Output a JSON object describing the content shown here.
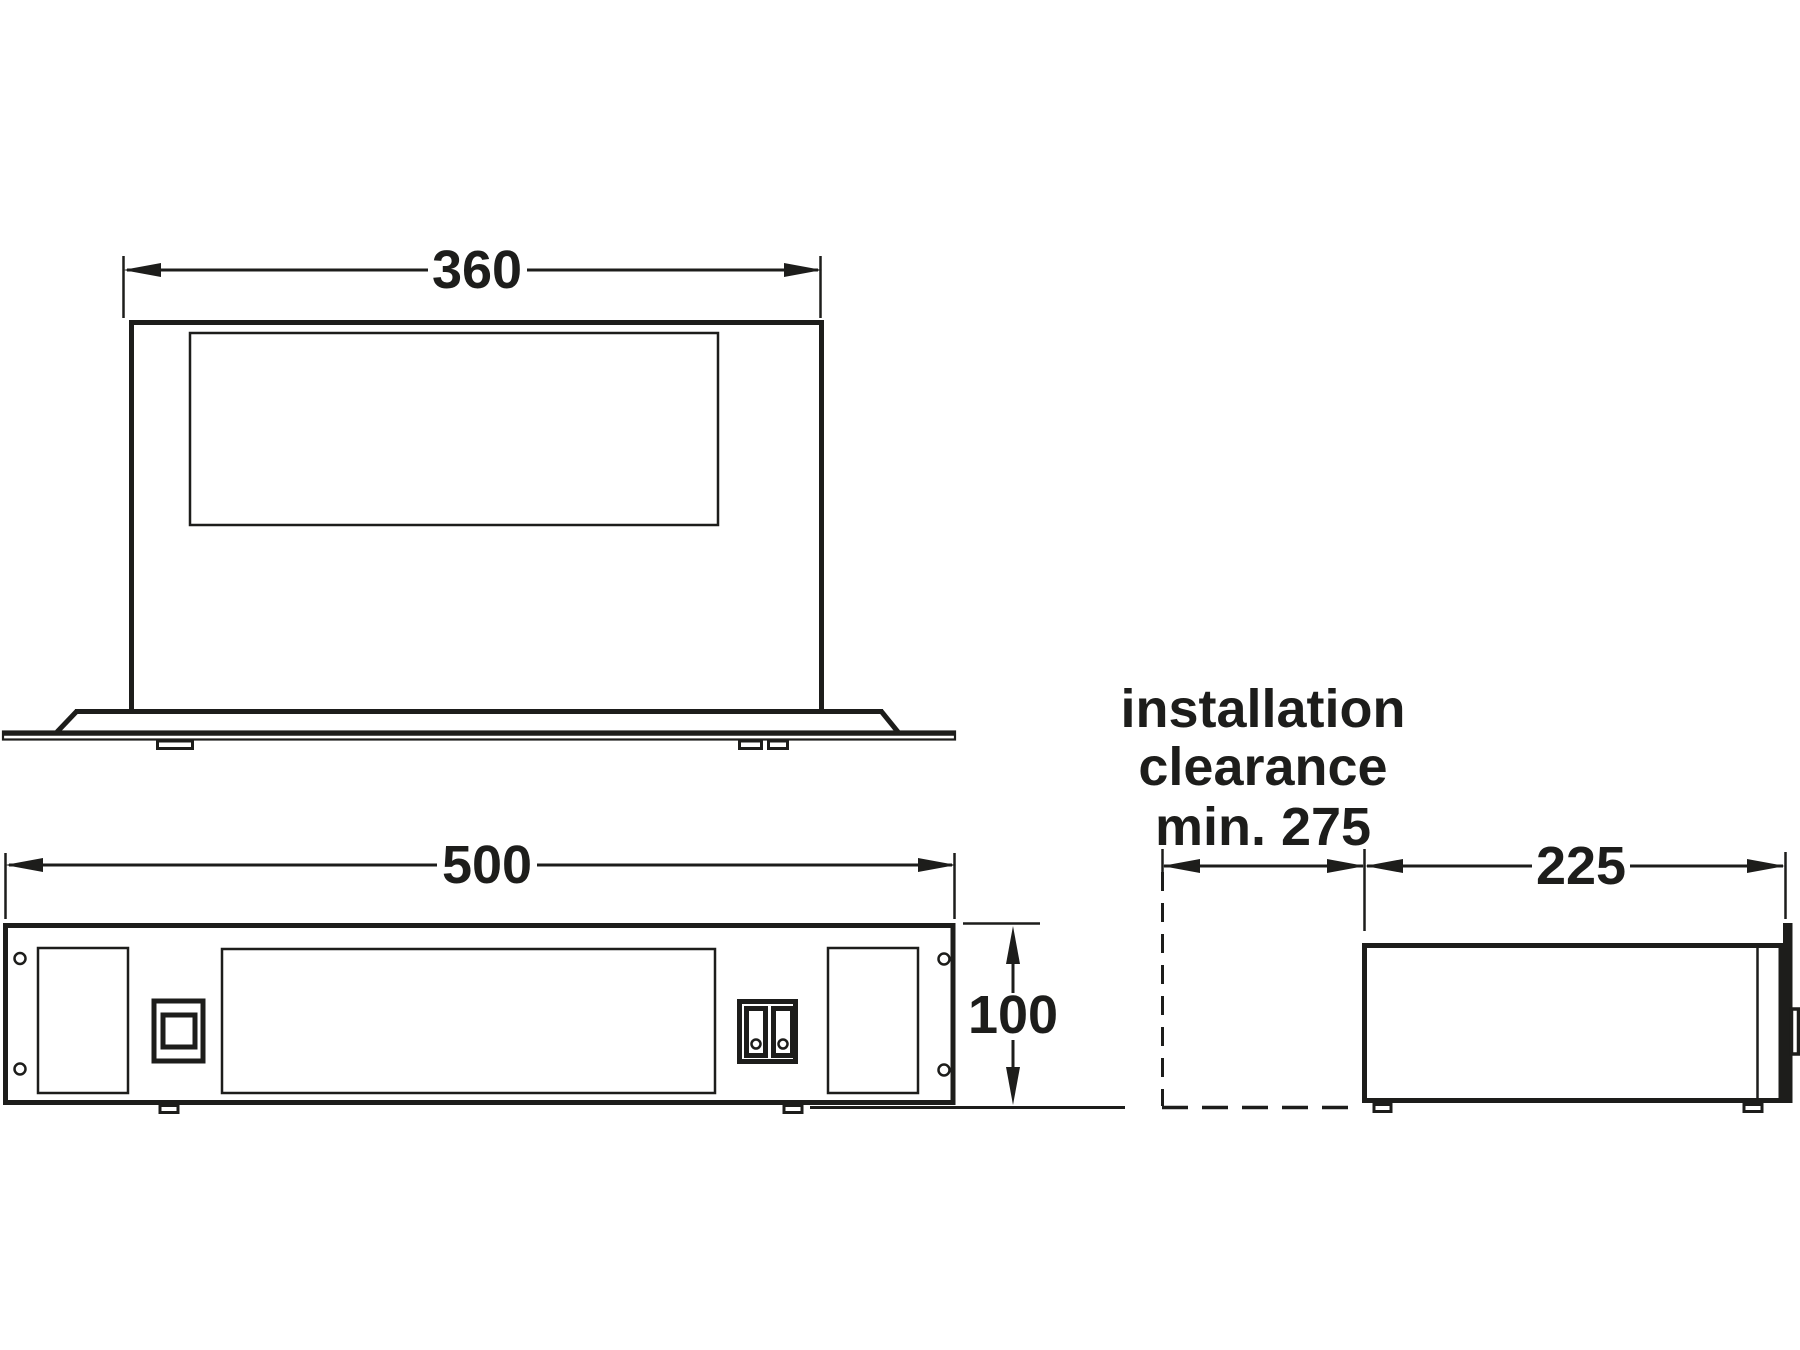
{
  "drawing": {
    "dimensions": {
      "top_width": "360",
      "front_width": "500",
      "front_height": "100",
      "side_depth": "225"
    },
    "note": {
      "line1": "installation",
      "line2": "clearance",
      "line3": "min. 275"
    },
    "colors": {
      "line": "#1d1d1b",
      "background": "#ffffff"
    }
  }
}
